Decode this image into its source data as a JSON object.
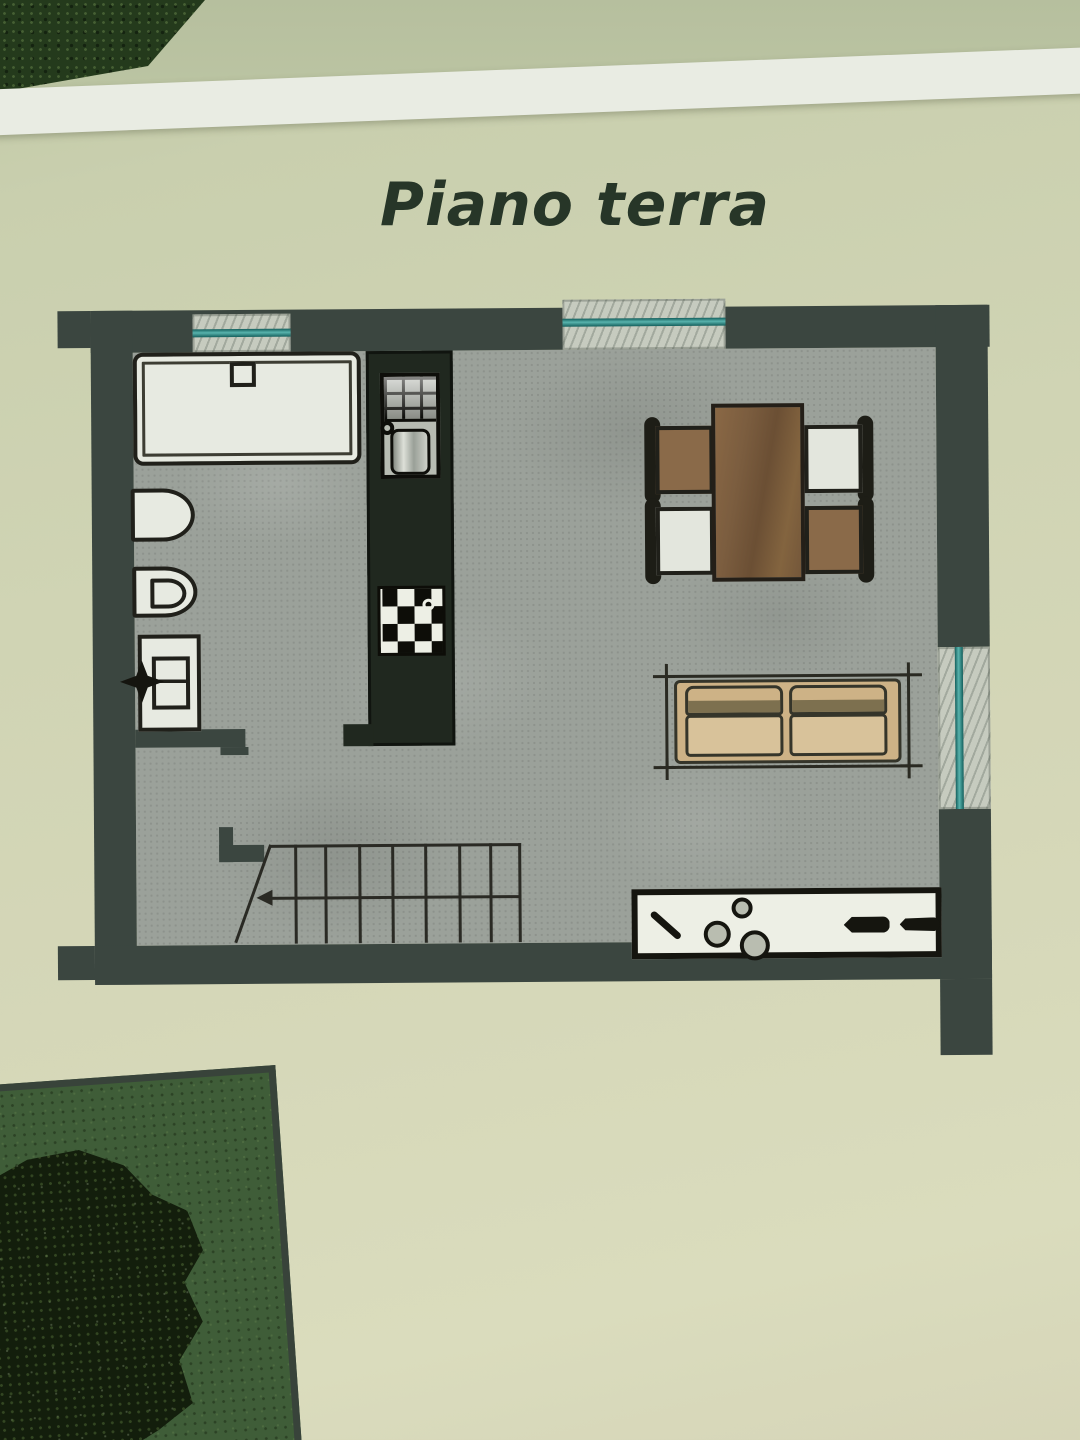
{
  "title": "Piano terra",
  "colors": {
    "paper": "#d0d4b4",
    "paper_top": "#b6bf9e",
    "page_edge": "#e9ece3",
    "title_ink": "#273628",
    "wall": "#3b4640",
    "floor": "#9ba19a",
    "fixture_white": "#e7eae1",
    "fixture_line": "#20201a",
    "kitchen_dark": "#20281f",
    "metal": "#b7bbb2",
    "glass_teal": "#1f7c78",
    "glass_teal_light": "#58b3ad",
    "sill_marble": "#c6cbbf",
    "table_brown": "#7b5d3f",
    "chair_brown": "#8a6a49",
    "sofa_beige": "#cdb286",
    "sofa_seat": "#d8c29a",
    "counter_white": "#edefe5",
    "garden_green": "#3f5d38",
    "tree_dark": "#131e0c"
  },
  "plan": {
    "symbols": [
      "bathtub",
      "washbasin",
      "toilet",
      "washing-machine",
      "valve-star",
      "kitchen-sink",
      "cooktop",
      "dining-table",
      "dining-chairs",
      "sofa",
      "staircase",
      "direction-arrow",
      "sideboard",
      "window-glass",
      "marble-sill",
      "lawn",
      "tree"
    ]
  }
}
